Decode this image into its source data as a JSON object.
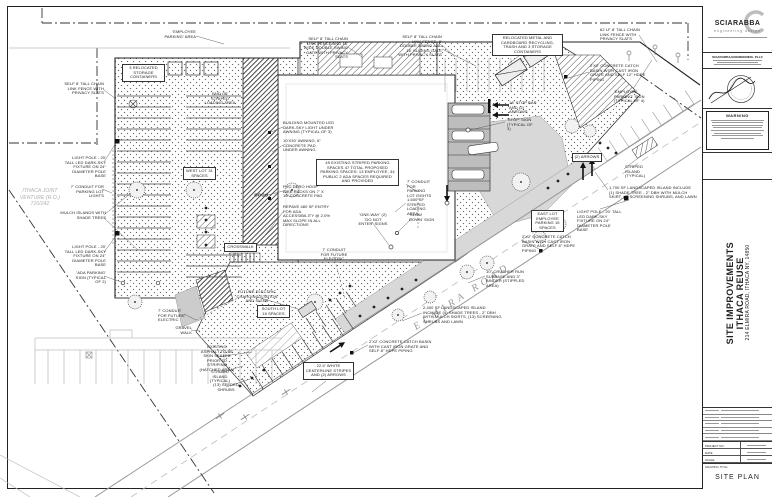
{
  "colors": {
    "ink": "#222222",
    "annotation_text": "#1c1c1c",
    "gray_linework": "#9a9a9a",
    "light_concrete": "#d8d8d8",
    "paper": "#ffffff"
  },
  "titleblock": {
    "logo_name": "SCIARABBA",
    "logo_tagline": "engineering design",
    "firm_name": "SCIARABBA ENGINEERING, PLLC",
    "warning_title": "WARNING",
    "project_name_line1": "SITE IMPROVEMENTS",
    "project_name_line2": "ITHACA REUSE",
    "project_address": "214 ELMIRA ROAD, ITHACA NY, 14850",
    "drawing_title_label": "DRAWING TITLE",
    "drawing_title": "SITE PLAN",
    "fields": [
      {
        "label": "PROJECT NO."
      },
      {
        "label": "DATE"
      },
      {
        "label": "SCALE"
      }
    ]
  },
  "road_label": "ELMIRA ROAD",
  "annotations": [
    {
      "id": "employee-parking-area",
      "text": "'EMPLOYEE PARKING' AREA",
      "x": 158,
      "y": 30,
      "w": 38,
      "align": "right"
    },
    {
      "id": "relocated-storage-containers",
      "text": "3 RELOCATED STORAGE CONTAINERS",
      "x": 122,
      "y": 64,
      "w": 38,
      "align": "center",
      "boxed": true
    },
    {
      "id": "fence-west",
      "text": "SELF 8' TALL CHAIN LINK FENCE WITH PRIVACY SLATS",
      "x": 62,
      "y": 82,
      "w": 42,
      "align": "right"
    },
    {
      "id": "end-striped-loading",
      "text": "END OF STRIPED LOADING AREA",
      "x": 203,
      "y": 92,
      "w": 34,
      "align": "center"
    },
    {
      "id": "fence-north-gate",
      "text": "SELF 8' TALL CHAIN LINK FENCE AND 16' WIDE DOUBLE SWING GATE WITH PRIVACY SLATS",
      "x": 302,
      "y": 37,
      "w": 46,
      "align": "right"
    },
    {
      "id": "fence-north-sliding-gate",
      "text": "SELF 8' TALL CHAIN LINK FENCE, 8' DOUBLE SWING AND 16' SLIDING GATE WITH PRIVACY SLATS",
      "x": 396,
      "y": 35,
      "w": 46,
      "align": "right"
    },
    {
      "id": "relocated-recycling",
      "text": "RELOCATED METAL AND CARDBOARD RECYCLING, TRASH AND 3 STORAGE CONTAINERS",
      "x": 492,
      "y": 34,
      "w": 66,
      "align": "center",
      "boxed": true
    },
    {
      "id": "fence-62lf",
      "text": "62 LF 8' TALL CHAIN LINK FENCE WITH PRIVACY SLATS",
      "x": 600,
      "y": 28,
      "w": 40,
      "align": "left"
    },
    {
      "id": "catch-basin-ne",
      "text": "2'X2' CONCRETE CATCH BASIN WITH CAST IRON GRATE AND SELF 12\" HDPE PIPING",
      "x": 590,
      "y": 64,
      "w": 56,
      "align": "left"
    },
    {
      "id": "employee-parking-sign",
      "text": "'EMPLOYEE PARKING' SIGN (TYPICAL OF 4)",
      "x": 614,
      "y": 90,
      "w": 44,
      "align": "left"
    },
    {
      "id": "stop-bar",
      "text": "18' STOP BAR AND (2) ARROWS",
      "x": 509,
      "y": 101,
      "w": 32,
      "align": "left"
    },
    {
      "id": "stop-sign",
      "text": "'STOP' SIGN (TYPICAL OF 3)",
      "x": 507,
      "y": 118,
      "w": 30,
      "align": "left"
    },
    {
      "id": "building-led-lights",
      "text": "BUILDING MOUNTED LED DARK-SKY LIGHT UNDER AWNING (TYPICAL OF 3)",
      "x": 283,
      "y": 121,
      "w": 56,
      "align": "left"
    },
    {
      "id": "awning",
      "text": "10'X30' AWNING, 6\" CONCRETE PAD UNDER AWNING",
      "x": 283,
      "y": 139,
      "w": 44,
      "align": "left"
    },
    {
      "id": "parking-count-note",
      "text": "49 EXISTING STRIPED PARKING SPACES  47 TOTAL PROPOSED PARKING SPACES: 13 EMPLOYEE, 34 PUBLIC  2 ADA SPACES REQUIRED AND PROVIDED",
      "x": 316,
      "y": 159,
      "w": 78,
      "align": "center",
      "boxed": true
    },
    {
      "id": "bike-racks",
      "text": "PVC DERO HOOP BIKE RACKS ON 7' X 16' CONCRETE PAD",
      "x": 283,
      "y": 185,
      "w": 44,
      "align": "left"
    },
    {
      "id": "repave-entry",
      "text": "REPAVE 480 SF ENTRY FOR ADA ACCESSIBILITY @ 2.0% MAX SLOPE IN ALL DIRECTIONS",
      "x": 283,
      "y": 205,
      "w": 48,
      "align": "left"
    },
    {
      "id": "west-lot",
      "text": "WEST LOT 31 SPACES",
      "x": 183,
      "y": 167,
      "w": 28,
      "align": "center",
      "boxed": true
    },
    {
      "id": "conduit-parking-east",
      "text": "7' CONDUIT FOR PARKING LOT LIGHTS",
      "x": 407,
      "y": 180,
      "w": 26,
      "align": "left"
    },
    {
      "id": "striped-loading-area",
      "text": "1,600 SF STRIPED LOADING AREA",
      "x": 407,
      "y": 198,
      "w": 28,
      "align": "left"
    },
    {
      "id": "one-way-signs",
      "text": "'ONE-WAY' (2) 'DO NOT ENTER' SIGNS",
      "x": 358,
      "y": 213,
      "w": 30,
      "align": "center"
    },
    {
      "id": "slow-down-sign",
      "text": "'SLOW DOWN' SIGN",
      "x": 409,
      "y": 213,
      "w": 26,
      "align": "left"
    },
    {
      "id": "two-arrows",
      "text": "(2) ARROWS",
      "x": 572,
      "y": 153,
      "w": 25,
      "align": "center",
      "boxed": true
    },
    {
      "id": "landscaped-island-1700",
      "text": "1,700 SF LANDSCAPED ISLAND INCLUDE (1) SHADE TREE - 2\" DBH WITH MULCH SKIRT, (5) SCREENING SHRUBS, AND LAWN",
      "x": 609,
      "y": 186,
      "w": 88,
      "align": "left"
    },
    {
      "id": "light-pole-east",
      "text": "LIGHT POLE - 20' TALL LED DARK-SKY FIXTURE ON 24\" DIAMETER POLE BASE",
      "x": 577,
      "y": 210,
      "w": 46,
      "align": "left"
    },
    {
      "id": "east-lot",
      "text": "EAST LOT EMPLOYEE PARKING 15 SPACES",
      "x": 531,
      "y": 210,
      "w": 28,
      "align": "center",
      "boxed": true
    },
    {
      "id": "catch-basin-east",
      "text": "2'X2' CONCRETE CATCH BASIN WITH CAST IRON GRATE AND SELF 8\" HDPE PIPING",
      "x": 522,
      "y": 235,
      "w": 60,
      "align": "left"
    },
    {
      "id": "striped-island-east",
      "text": "STRIPED ISLAND (TYPICAL)",
      "x": 625,
      "y": 165,
      "w": 34,
      "align": "left"
    },
    {
      "id": "parcel-label",
      "text": "ITHACA JOINT VENTURE (R.O.) 710/242",
      "x": 14,
      "y": 188,
      "w": 52,
      "align": "center",
      "cls": "parcel"
    },
    {
      "id": "light-pole-west-1",
      "text": "LIGHT POLE - 20' TALL LED DARK-SKY FIXTURE ON 24\" DIAMETER POLE BASE",
      "x": 62,
      "y": 156,
      "w": 44,
      "align": "right"
    },
    {
      "id": "conduit-parking-west",
      "text": "7' CONDUIT FOR PARKING LOT LIGHTS",
      "x": 68,
      "y": 185,
      "w": 36,
      "align": "right"
    },
    {
      "id": "mulch-islands",
      "text": "MULCH ISLANDS WITH SHADE TREES",
      "x": 60,
      "y": 211,
      "w": 46,
      "align": "right"
    },
    {
      "id": "light-pole-west-2",
      "text": "LIGHT POLE - 20' TALL LED DARK-SKY FIXTURE ON 24\" DIAMETER POLE BASE",
      "x": 62,
      "y": 245,
      "w": 44,
      "align": "right"
    },
    {
      "id": "ada-parking-sign",
      "text": "'ADA PARKING' SIGN (TYPICAL OF 2)",
      "x": 72,
      "y": 271,
      "w": 34,
      "align": "right"
    },
    {
      "id": "conduit-future-sw",
      "text": "7' CONDUIT FOR FUTURE ELECTRIC",
      "x": 158,
      "y": 309,
      "w": 28,
      "align": "left"
    },
    {
      "id": "future-ev-charging",
      "text": "FUTURE ELECTRIC CHARGING STATION AND SIGNS",
      "x": 236,
      "y": 290,
      "w": 42,
      "align": "center"
    },
    {
      "id": "south-lot",
      "text": "SOUTH LOT 16 SPACES",
      "x": 257,
      "y": 305,
      "w": 28,
      "align": "center",
      "boxed": true
    },
    {
      "id": "gravel-walk",
      "text": "GRAVEL WALK",
      "x": 166,
      "y": 326,
      "w": 26,
      "align": "right"
    },
    {
      "id": "existing-asphalt",
      "text": "EXISTING ASPHALT TO BE SKIN SEALED PRIOR TO STRIPING (HATCHED AREA)",
      "x": 198,
      "y": 345,
      "w": 38,
      "align": "center"
    },
    {
      "id": "striped-island-south",
      "text": "STRIPED ISLAND (TYPICAL)",
      "x": 204,
      "y": 370,
      "w": 32,
      "align": "center"
    },
    {
      "id": "seeded-shrubs",
      "text": "(13) SEEDED SHRUBS",
      "x": 213,
      "y": 383,
      "w": 26,
      "align": "center"
    },
    {
      "id": "centerline-stripes",
      "text": "22.5' WHITE CENTERLINE STRIPES AND (2) ARROWS",
      "x": 303,
      "y": 362,
      "w": 46,
      "align": "center",
      "boxed": true
    },
    {
      "id": "conduit-future-center",
      "text": "7' CONDUIT FOR FUTURE ELECTRIC",
      "x": 319,
      "y": 248,
      "w": 30,
      "align": "center"
    },
    {
      "id": "crusher-run",
      "text": "10\" CRUSHER RUN SUBBASE AND 3\" BINDER (STIPPLED AREA)",
      "x": 486,
      "y": 270,
      "w": 48,
      "align": "left"
    },
    {
      "id": "landscaped-island-2400",
      "text": "2,400 SF LANDSCAPED ISLAND INCLUDE (4) SHADE TREES - 2\" DBH WITH MULCH SKIRTS, (13) SCREENING SHRUBS AND LAWN",
      "x": 423,
      "y": 306,
      "w": 80,
      "align": "left"
    },
    {
      "id": "catch-basin-south",
      "text": "2'X2' CONCRETE CATCH BASIN WITH CAST IRON GRATE AND SELF 8\" HDPE PIPING",
      "x": 369,
      "y": 340,
      "w": 64,
      "align": "left"
    },
    {
      "id": "crosswalk",
      "text": "CROSSWALK",
      "x": 224,
      "y": 243,
      "w": 28,
      "align": "center",
      "boxed": true
    }
  ]
}
